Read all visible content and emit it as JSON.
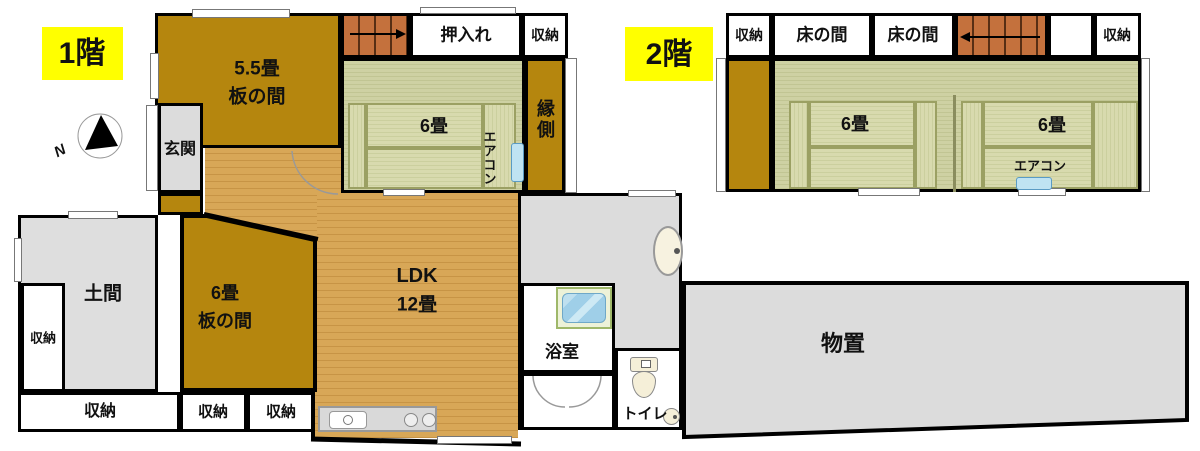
{
  "floor1": {
    "label": "1階",
    "compass_n": "N",
    "room55_size": "5.5畳",
    "room55_name": "板の間",
    "oshiire": "押入れ",
    "shuno_top": "収納",
    "tatami6": "6畳",
    "aircon": "エアコン",
    "engawa": "縁側",
    "genkan": "玄関",
    "doma": "土間",
    "shuno_left": "収納",
    "room6_size": "6畳",
    "room6_name": "板の間",
    "ldk_name": "LDK",
    "ldk_size": "12畳",
    "bath": "浴室",
    "toilet": "トイレ",
    "monooki": "物置",
    "shuno_bottom1": "収納",
    "shuno_bottom2": "収納",
    "shuno_bottom3": "収納"
  },
  "floor2": {
    "label": "2階",
    "shuno_left": "収納",
    "tokonoma1": "床の間",
    "tokonoma2": "床の間",
    "shuno_right": "収納",
    "tatami_left": "6畳",
    "tatami_right": "6畳",
    "aircon": "エアコン"
  },
  "colors": {
    "floor_tag": "#ffff00",
    "wall": "#000000",
    "wood_floor": "#d8a757",
    "board_room": "#b5860e",
    "tatami": "#ced1a3",
    "gray_room": "#dcdcdc",
    "stairs": "#c4713d",
    "aircon_unit": "#bfe3f2"
  }
}
